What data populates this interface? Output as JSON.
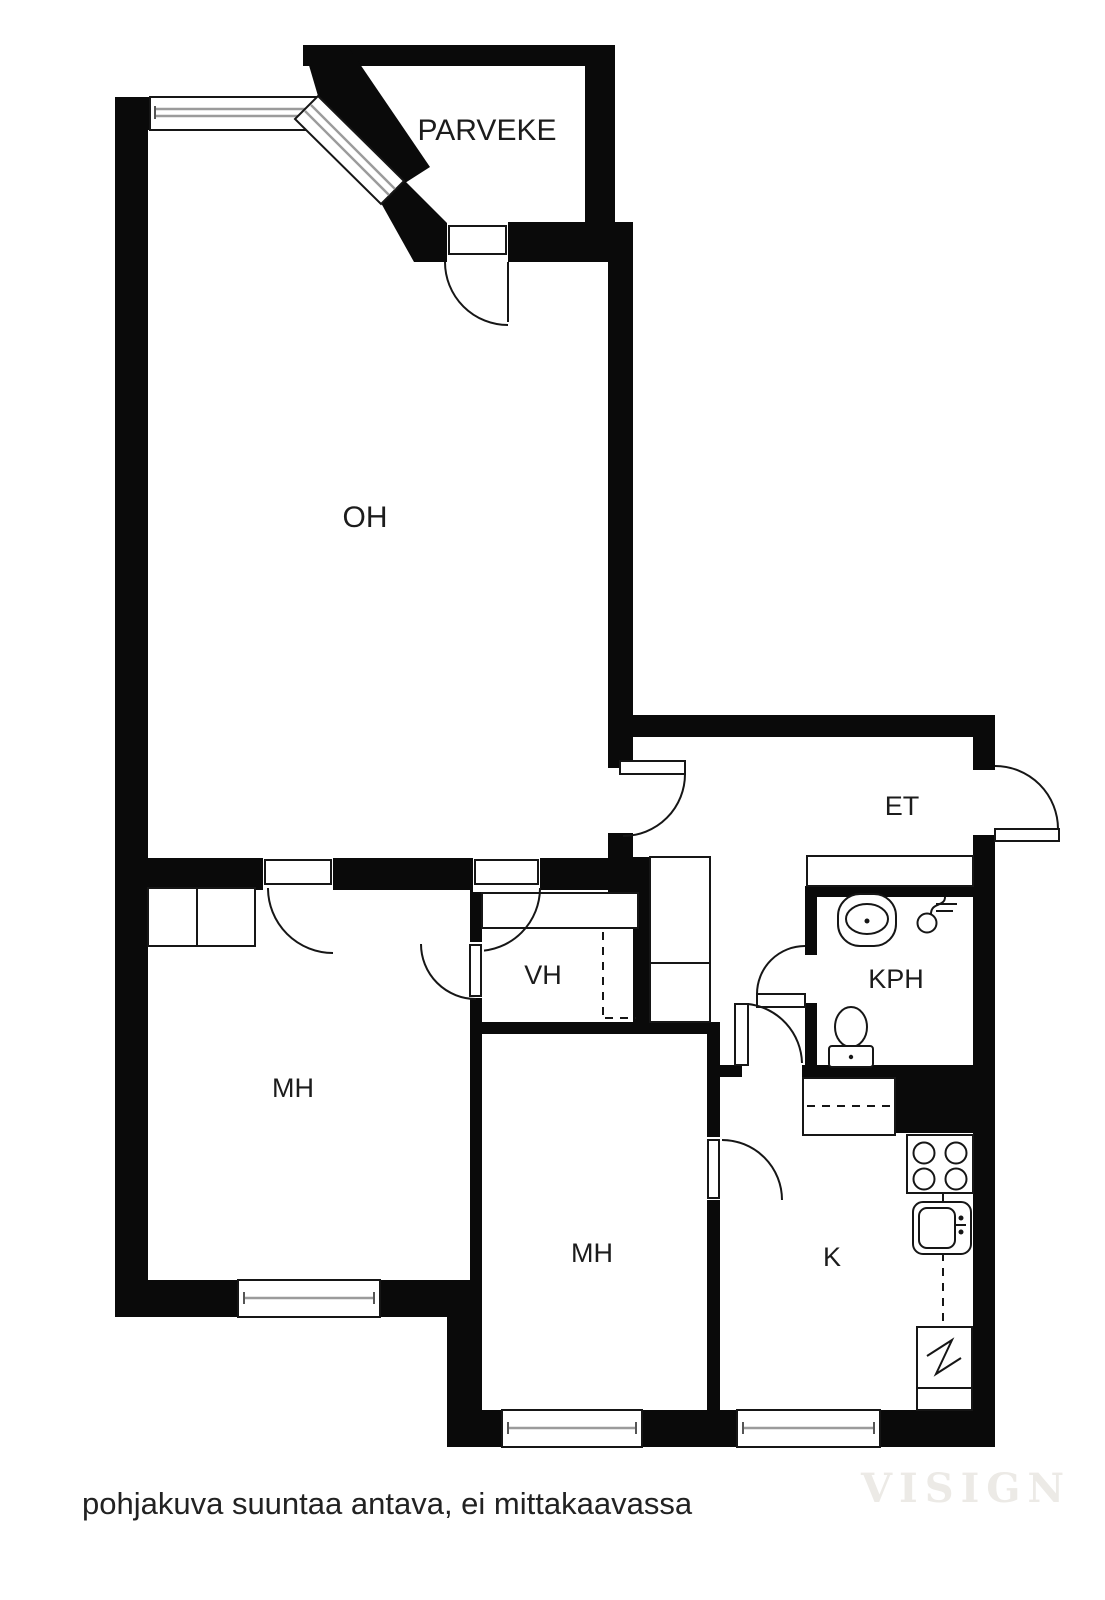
{
  "document": {
    "type": "floor-plan",
    "language": "fi"
  },
  "rooms": {
    "parveke": "PARVEKE",
    "oh": "OH",
    "et": "ET",
    "vh": "VH",
    "kph": "KPH",
    "mh_left": "MH",
    "mh_middle": "MH",
    "k": "K"
  },
  "caption": "pohjakuva suuntaa antava, ei mittakaavassa",
  "watermark": "VISIGN",
  "colors": {
    "wall": "#0a0a0a",
    "line": "#161616",
    "background": "#ffffff",
    "window_glass": "#9b9b9b",
    "watermark": "#eceae6",
    "text": "#1c1c1c"
  },
  "fixtures": {
    "kph": [
      "sink",
      "shower-mixer",
      "toilet"
    ],
    "k": [
      "counter-dashed",
      "stove-4-burners",
      "sink",
      "refrigerator-zigzag"
    ],
    "storage": [
      "bedroom-wardrobe",
      "hall-closets",
      "entry-shelf",
      "vh-rail-dashed"
    ]
  }
}
